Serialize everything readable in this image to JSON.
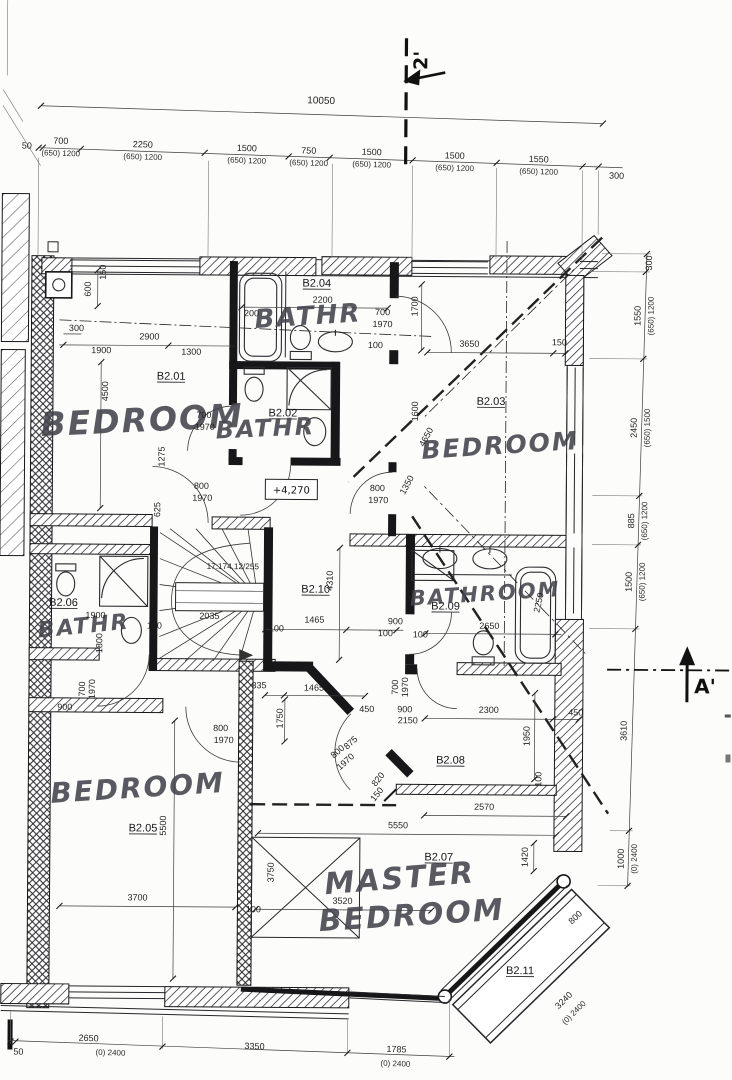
{
  "drawing_type": "architectural floor plan, second floor apartment",
  "markers": {
    "section_top": "2'",
    "section_right": "A'",
    "level": "+4,270",
    "stair_note": "17:174,12/255"
  },
  "rooms": [
    {
      "id": "B2.01",
      "label": "BEDROOM"
    },
    {
      "id": "B2.02",
      "label": "BATHR"
    },
    {
      "id": "B2.03",
      "label": "BEDROOM"
    },
    {
      "id": "B2.04",
      "label": "BATHR"
    },
    {
      "id": "B2.05",
      "label": "BEDROOM"
    },
    {
      "id": "B2.06",
      "label": "BATHR"
    },
    {
      "id": "B2.07",
      "label": "MASTER BEDROOM"
    },
    {
      "id": "B2.08",
      "label": ""
    },
    {
      "id": "B2.09",
      "label": "BATHROOM"
    },
    {
      "id": "B2.10",
      "label": ""
    },
    {
      "id": "B2.11",
      "label": ""
    }
  ],
  "dim_chains": {
    "top": {
      "total": "10050",
      "segments": [
        "50",
        "700",
        "2250",
        "1500",
        "750",
        "1500",
        "1500",
        "1550",
        "300"
      ],
      "window_label": "(650) 1200"
    },
    "right": {
      "segments": [
        "300",
        "1550",
        "2450",
        "885",
        "1500",
        "3610",
        "1000"
      ],
      "window_labels": [
        "(650) 1200",
        "(650) 1500",
        "(650) 1200",
        "(650) 1200",
        "(0) 2400"
      ]
    },
    "bottom": {
      "segments": [
        "50",
        "2650",
        "3350",
        "1785"
      ],
      "window_labels": [
        "(0) 2400",
        "(0) 2400"
      ]
    }
  },
  "texts": [
    [
      "dim-top-total",
      "10050",
      318,
      104,
      1.3,
      10,
      "d"
    ],
    [
      "dim-top-50",
      "50",
      24,
      151,
      1.3,
      9,
      "d"
    ],
    [
      "dim-top-700",
      "700",
      58,
      146,
      1.3,
      9,
      "d"
    ],
    [
      "win-top-700",
      "(650) 1200",
      58,
      158,
      1.3,
      8,
      "dw"
    ],
    [
      "dim-top-2250",
      "2250",
      140,
      149,
      1.3,
      9,
      "d"
    ],
    [
      "win-top-2250",
      "(650) 1200",
      140,
      161,
      1.3,
      8,
      "dw"
    ],
    [
      "dim-top-1500a",
      "1500",
      244,
      152,
      1.3,
      9,
      "d"
    ],
    [
      "win-top-1500a",
      "(650) 1200",
      244,
      164,
      1.3,
      8,
      "dw"
    ],
    [
      "dim-top-750",
      "750",
      306,
      154,
      1.3,
      9,
      "d"
    ],
    [
      "win-top-750",
      "(650) 1200",
      306,
      166,
      1.3,
      8,
      "dw"
    ],
    [
      "dim-top-1500b",
      "1500",
      369,
      155,
      1.3,
      9,
      "d"
    ],
    [
      "win-top-1500b",
      "(650) 1200",
      369,
      167,
      1.3,
      8,
      "dw"
    ],
    [
      "dim-top-1500c",
      "1500",
      452,
      158,
      1.3,
      9,
      "d"
    ],
    [
      "win-top-1500c",
      "(650) 1200",
      452,
      170,
      1.3,
      8,
      "dw"
    ],
    [
      "dim-top-1550",
      "1550",
      536,
      161,
      1.3,
      9,
      "d"
    ],
    [
      "win-top-1550",
      "(650) 1200",
      536,
      173,
      1.3,
      8,
      "dw"
    ],
    [
      "dim-top-300",
      "300",
      614,
      177,
      1.3,
      9,
      "d"
    ],
    [
      "dim-r-300",
      "300",
      650,
      261,
      -90,
      9,
      "d"
    ],
    [
      "dim-r-1550",
      "1550",
      639,
      314,
      -90,
      9,
      "d"
    ],
    [
      "win-r-1550",
      "(650) 1200",
      652,
      314,
      -90,
      8,
      "dw"
    ],
    [
      "dim-r-2450",
      "2450",
      636,
      426,
      -90,
      9,
      "d"
    ],
    [
      "win-r-2450",
      "(650) 1500",
      649,
      426,
      -90,
      8,
      "dw"
    ],
    [
      "dim-r-885",
      "885",
      634,
      519,
      -90,
      9,
      "d"
    ],
    [
      "win-r-885",
      "(650) 1200",
      647,
      519,
      -90,
      8,
      "dw"
    ],
    [
      "dim-r-1500",
      "1500",
      632,
      580,
      -90,
      9,
      "d"
    ],
    [
      "win-r-1500",
      "(650) 1200",
      645,
      580,
      -90,
      8,
      "dw"
    ],
    [
      "dim-r-3610",
      "3610",
      628,
      729,
      -90,
      9,
      "d"
    ],
    [
      "dim-r-1000",
      "1000",
      626,
      857,
      -90,
      9,
      "d"
    ],
    [
      "win-r-1000",
      "(0) 2400",
      639,
      857,
      -90,
      8,
      "dw"
    ],
    [
      "dim-b-50",
      "50",
      22,
      1057,
      0,
      9,
      "d"
    ],
    [
      "dim-b-2650",
      "2650",
      92,
      1043,
      1.5,
      9,
      "d"
    ],
    [
      "win-b-2650",
      "(0) 2400",
      114,
      1057,
      1.5,
      8,
      "dw"
    ],
    [
      "dim-b-3350",
      "3350",
      258,
      1050,
      1.5,
      9,
      "d"
    ],
    [
      "dim-b-1785",
      "1785",
      400,
      1052,
      1.5,
      9,
      "d"
    ],
    [
      "win-b-1785",
      "(0) 2400",
      399,
      1066,
      1.5,
      8,
      "dw"
    ],
    [
      "section-top-label",
      "2'",
      424,
      60,
      -90,
      19,
      "mark"
    ],
    [
      "section-right-label",
      "A'",
      706,
      691,
      0,
      20,
      "mark"
    ],
    [
      "level-label",
      "+4,270",
      291,
      494,
      0,
      10,
      "lvl"
    ],
    [
      "stair-note-label",
      "17:174,12/255",
      233,
      570,
      0,
      8.2,
      "d"
    ],
    [
      "room-id-b201",
      "B2.01",
      170,
      381,
      0,
      11,
      "id"
    ],
    [
      "room-label-b201",
      "BEDROOM",
      142,
      433,
      -3,
      33,
      "hand"
    ],
    [
      "room-id-b204",
      "B2.04",
      315,
      287,
      0,
      11,
      "id"
    ],
    [
      "room-label-b204",
      "BATHR",
      307,
      325,
      -4,
      26,
      "hand"
    ],
    [
      "room-id-b202",
      "B2.02",
      282,
      417,
      0,
      11,
      "id"
    ],
    [
      "room-label-b202",
      "BATHR",
      265,
      437,
      -3,
      24,
      "hand"
    ],
    [
      "room-id-b203",
      "B2.03",
      490,
      404,
      0,
      11,
      "id"
    ],
    [
      "room-label-b203",
      "BEDROOM",
      500,
      453,
      -4,
      25,
      "hand"
    ],
    [
      "room-id-b210",
      "B2.10",
      316,
      593,
      0,
      11,
      "id"
    ],
    [
      "room-id-b209",
      "B2.09",
      446,
      609,
      0,
      11,
      "id"
    ],
    [
      "room-label-b209",
      "BATHROOM",
      486,
      600,
      -4,
      21,
      "hand"
    ],
    [
      "room-id-b206",
      "B2.06",
      64,
      608,
      0,
      11,
      "id"
    ],
    [
      "room-label-b206",
      "BATHR",
      85,
      635,
      -6,
      22,
      "hand"
    ],
    [
      "room-id-b205",
      "B2.05",
      145,
      833,
      0,
      11,
      "id"
    ],
    [
      "room-label-b205",
      "BEDROOM",
      140,
      799,
      -4,
      28,
      "hand"
    ],
    [
      "room-id-b207",
      "B2.07",
      441,
      860,
      0,
      11,
      "id"
    ],
    [
      "room-label-b207-line1",
      "MASTER",
      403,
      888,
      -5,
      30,
      "hand"
    ],
    [
      "room-label-b207-line2",
      "BEDROOM",
      415,
      925,
      -4,
      30,
      "hand"
    ],
    [
      "room-id-b208",
      "B2.08",
      452,
      763,
      0,
      11,
      "id"
    ],
    [
      "room-id-b211",
      "B2.11",
      523,
      973,
      0,
      11,
      "id"
    ],
    [
      "dim-600",
      "600",
      89,
      291,
      -90,
      9,
      "d"
    ],
    [
      "dim-150-a",
      "150",
      104,
      274,
      -90,
      9,
      "d"
    ],
    [
      "dim-300-a",
      "300",
      75,
      333,
      0,
      9,
      "d"
    ],
    [
      "dim-2900",
      "2900",
      148,
      341,
      0,
      9,
      "d"
    ],
    [
      "dim-1900-a",
      "1900",
      100,
      355,
      0,
      9,
      "d"
    ],
    [
      "dim-1300",
      "1300",
      190,
      356,
      0,
      9,
      "d"
    ],
    [
      "dim-4500",
      "4500",
      107,
      393,
      -90,
      9,
      "d"
    ],
    [
      "dim-1275",
      "1275",
      164,
      458,
      -90,
      9,
      "d"
    ],
    [
      "dim-200",
      "200",
      250,
      317,
      0,
      9,
      "d"
    ],
    [
      "dim-2200",
      "2200",
      321,
      303,
      0,
      9,
      "d"
    ],
    [
      "door-b204-w",
      "700",
      381,
      315,
      0,
      9,
      "d"
    ],
    [
      "door-b204-h",
      "1970",
      381,
      327,
      0,
      9,
      "d"
    ],
    [
      "dim-1700",
      "1700",
      416,
      306,
      -90,
      9,
      "d"
    ],
    [
      "dim-100-a",
      "100",
      374,
      348,
      0,
      9,
      "d"
    ],
    [
      "dim-3650",
      "3650",
      468,
      346,
      0,
      9,
      "d"
    ],
    [
      "dim-150-b",
      "150",
      558,
      344,
      0,
      9,
      "d"
    ],
    [
      "door-b201-w",
      "700",
      203,
      419,
      0,
      9,
      "d"
    ],
    [
      "door-b201-h",
      "1970",
      204,
      431,
      0,
      9,
      "d"
    ],
    [
      "dim-625",
      "625",
      160,
      511,
      -90,
      9,
      "d"
    ],
    [
      "door-landing-w",
      "800",
      201,
      490,
      0,
      9,
      "d"
    ],
    [
      "door-landing-h",
      "1970",
      202,
      502,
      0,
      9,
      "d"
    ],
    [
      "door-b203-w",
      "800",
      377,
      491,
      0,
      9,
      "d"
    ],
    [
      "door-b203-h",
      "1970",
      378,
      503,
      0,
      9,
      "d"
    ],
    [
      "dim-1600",
      "1600",
      417,
      411,
      -90,
      9,
      "d"
    ],
    [
      "dim-4650",
      "4650",
      428,
      438,
      -62,
      9,
      "d"
    ],
    [
      "dim-1350",
      "1350",
      409,
      486,
      -62,
      9,
      "d"
    ],
    [
      "dim-4310",
      "4310",
      333,
      581,
      -90,
      9,
      "d"
    ],
    [
      "dim-1465-a",
      "1465",
      315,
      623,
      0,
      9,
      "d"
    ],
    [
      "dim-900-a",
      "900",
      396,
      624,
      0,
      9,
      "d"
    ],
    [
      "dim-100-b",
      "100",
      386,
      636,
      0,
      9,
      "d"
    ],
    [
      "dim-2650",
      "2650",
      490,
      628,
      0,
      9,
      "d"
    ],
    [
      "dim-2250",
      "2250",
      542,
      602,
      -78,
      9,
      "d"
    ],
    [
      "dim-100-c",
      "100",
      421,
      637,
      0,
      9,
      "d"
    ],
    [
      "dim-2035",
      "2035",
      210,
      620,
      0,
      9,
      "d"
    ],
    [
      "dim-100-d",
      "100",
      155,
      630,
      0,
      9,
      "d"
    ],
    [
      "dim-100-e",
      "100",
      277,
      632,
      0,
      9,
      "d"
    ],
    [
      "dim-1900-b",
      "1900",
      96,
      620,
      0,
      9,
      "d"
    ],
    [
      "dim-1800",
      "1800",
      103,
      645,
      -90,
      9,
      "d"
    ],
    [
      "door-b206-w",
      "700",
      86,
      691,
      -90,
      9,
      "d"
    ],
    [
      "door-b206-h",
      "1970",
      96,
      691,
      -90,
      9,
      "d"
    ],
    [
      "dim-900-b",
      "900",
      66,
      712,
      0,
      9,
      "d"
    ],
    [
      "dim-1465-b",
      "1465",
      315,
      691,
      0,
      9,
      "d"
    ],
    [
      "dim-335",
      "335",
      260,
      689,
      0,
      9,
      "d"
    ],
    [
      "dim-450-a",
      "450",
      368,
      712,
      0,
      9,
      "d"
    ],
    [
      "dim-1750",
      "1750",
      284,
      719,
      -90,
      9,
      "d"
    ],
    [
      "door-b205-w",
      "800",
      222,
      732,
      0,
      9,
      "d"
    ],
    [
      "door-b205-h",
      "1970",
      225,
      744,
      0,
      9,
      "d"
    ],
    [
      "dim-5500",
      "5500",
      168,
      827,
      -90,
      9,
      "d"
    ],
    [
      "dim-3700",
      "3700",
      140,
      902,
      0,
      9,
      "d"
    ],
    [
      "dim-100-f",
      "100",
      256,
      913,
      0,
      9,
      "d"
    ],
    [
      "dim-3750",
      "3750",
      276,
      873,
      -90,
      9,
      "d"
    ],
    [
      "dim-875",
      "875",
      354,
      745,
      -42,
      9,
      "d"
    ],
    [
      "door-b207-w",
      "800",
      341,
      754,
      -42,
      9,
      "d"
    ],
    [
      "door-b207-h",
      "1970",
      349,
      764,
      -42,
      9,
      "d"
    ],
    [
      "dim-820",
      "820",
      382,
      781,
      -52,
      9,
      "d"
    ],
    [
      "dim-150-c",
      "150",
      381,
      796,
      -52,
      9,
      "d"
    ],
    [
      "door-b208-w",
      "700",
      399,
      687,
      -90,
      9,
      "d"
    ],
    [
      "door-b208-h",
      "1970",
      409,
      687,
      -90,
      9,
      "d"
    ],
    [
      "dim-900-c",
      "900",
      406,
      712,
      0,
      9,
      "d"
    ],
    [
      "dim-2150",
      "2150",
      409,
      723,
      0,
      9,
      "d"
    ],
    [
      "dim-2300",
      "2300",
      490,
      712,
      0,
      9,
      "d"
    ],
    [
      "dim-450-b",
      "450",
      577,
      714,
      0,
      9,
      "d"
    ],
    [
      "dim-1950",
      "1950",
      531,
      735,
      -90,
      9,
      "d"
    ],
    [
      "dim-100-g",
      "100",
      543,
      778,
      -90,
      9,
      "d"
    ],
    [
      "dim-2570",
      "2570",
      486,
      809,
      0,
      9,
      "d"
    ],
    [
      "dim-5550",
      "5550",
      400,
      828,
      0,
      9,
      "d"
    ],
    [
      "dim-1420",
      "1420",
      530,
      856,
      -90,
      9,
      "d"
    ],
    [
      "dim-3520",
      "3520",
      345,
      904,
      0,
      9,
      "d"
    ],
    [
      "dim-b211-800",
      "800",
      580,
      918,
      -45,
      9,
      "d"
    ],
    [
      "dim-b211-3240",
      "3240",
      569,
      1001,
      -45,
      9,
      "d"
    ],
    [
      "win-b211",
      "(0) 2400",
      579,
      1013,
      -45,
      8,
      "dw"
    ]
  ]
}
